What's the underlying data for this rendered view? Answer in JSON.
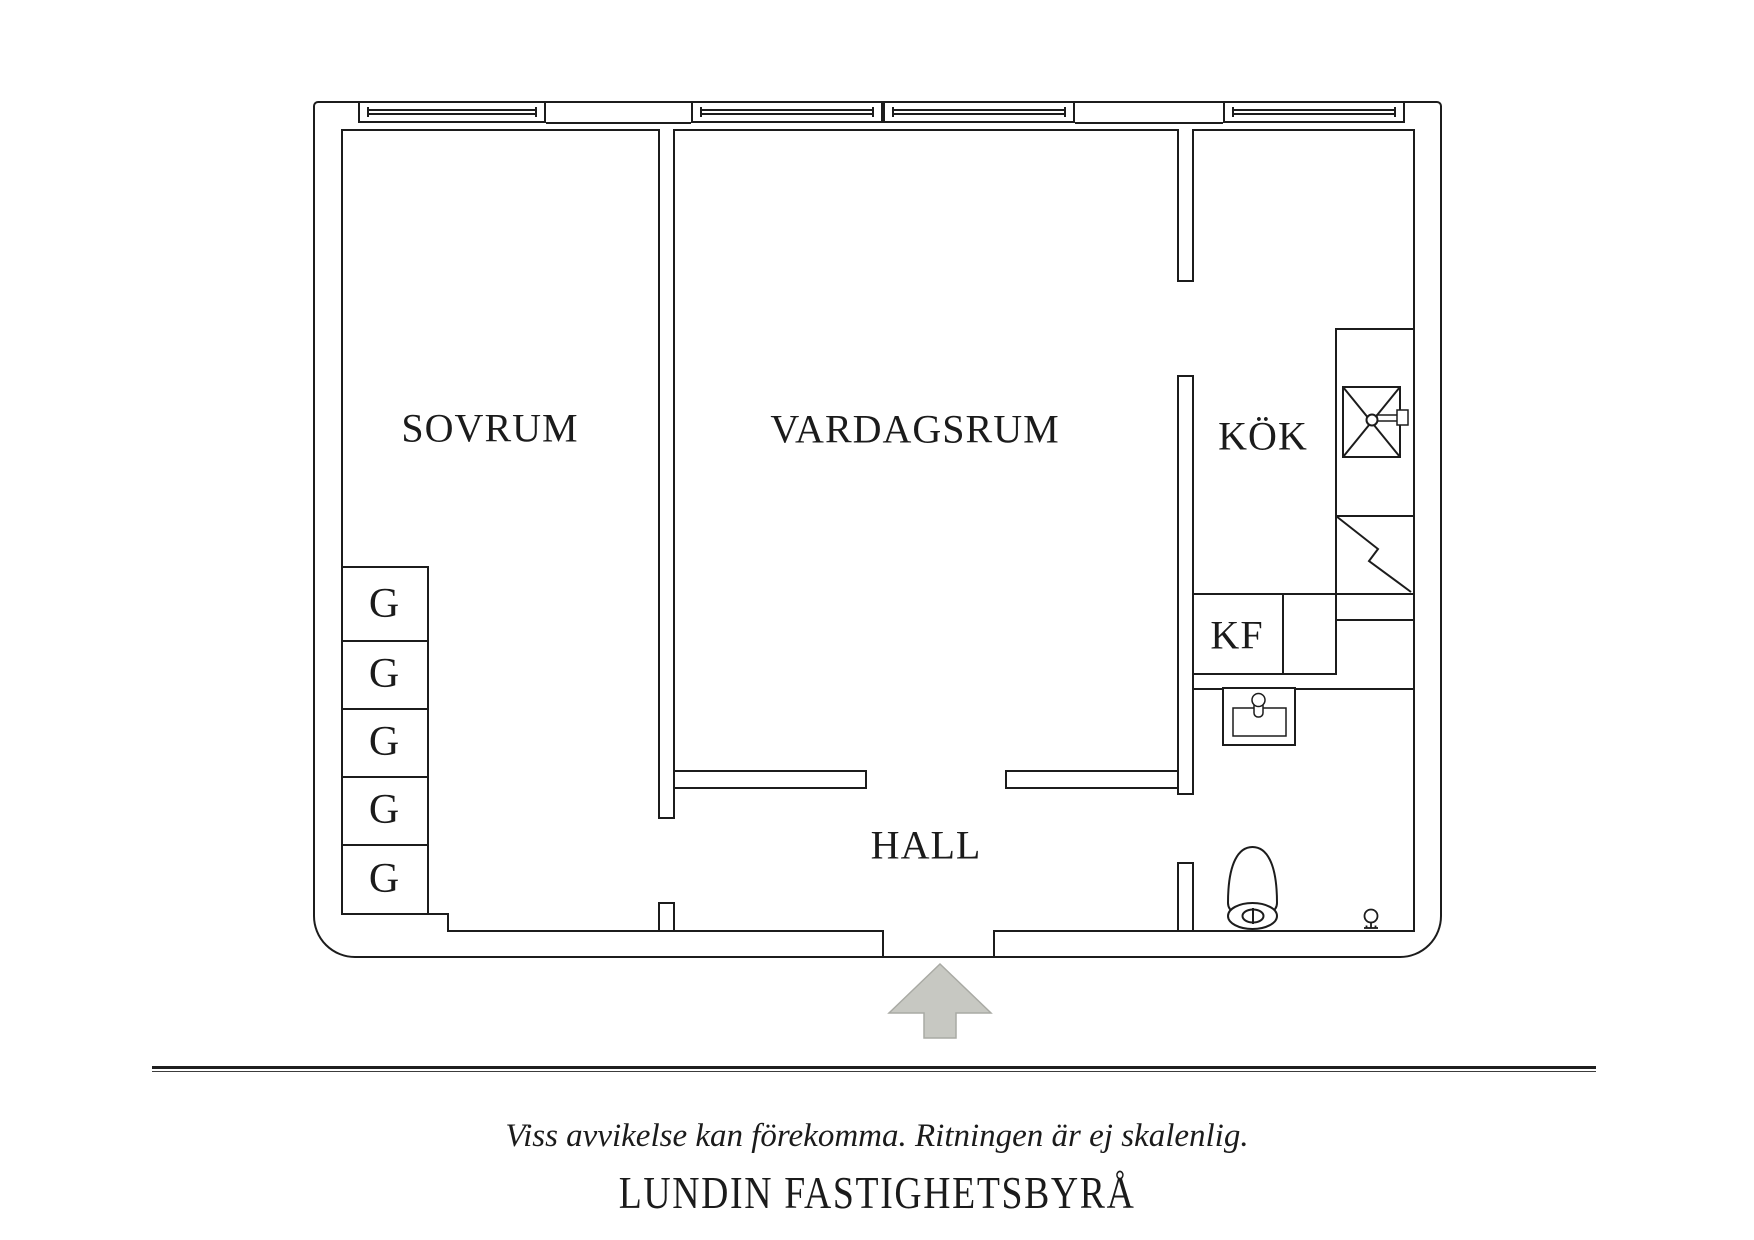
{
  "document": {
    "type": "apartment-floor-plan"
  },
  "rooms": {
    "bedroom": "SOVRUM",
    "living_room": "VARDAGSRUM",
    "kitchen": "KÖK",
    "hall": "HALL",
    "fridge_freezer": "KF"
  },
  "closets": [
    {
      "label": "G"
    },
    {
      "label": "G"
    },
    {
      "label": "G"
    },
    {
      "label": "G"
    },
    {
      "label": "G"
    }
  ],
  "fixtures": {
    "kitchen_sink": "kitchen-sink-icon",
    "counter_break": "counter-zigzag-icon",
    "bathroom_sink": "bathroom-sink-icon",
    "toilet": "toilet-icon",
    "floor_drain": "floor-drain-icon",
    "entrance": "entrance-arrow-icon",
    "windows": "window-symbol"
  },
  "footer": {
    "disclaimer": "Viss avvikelse kan förekomma. Ritningen är ej skalenlig.",
    "brand": "LUNDIN FASTIGHETSBYRÅ"
  },
  "colors": {
    "line": "#1c1c1c",
    "arrow_fill": "#c7c8c2",
    "arrow_stroke": "#a9aaa4",
    "background": "#ffffff"
  }
}
